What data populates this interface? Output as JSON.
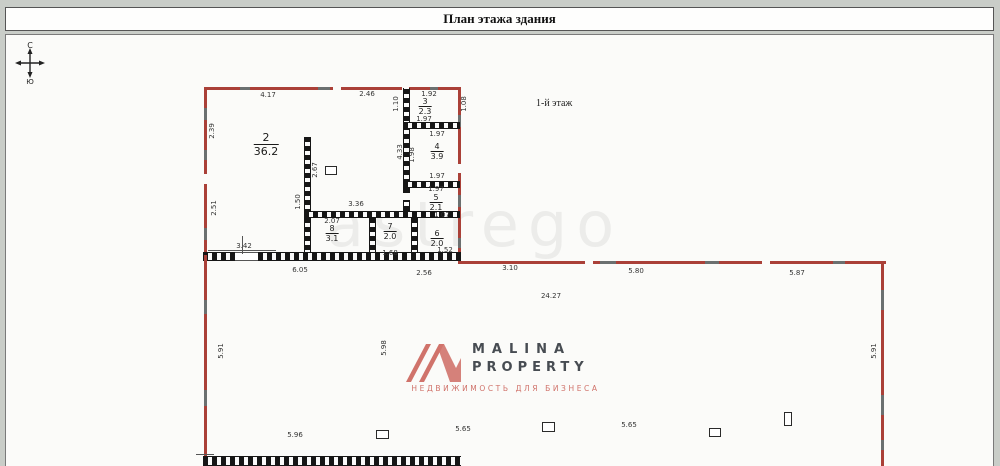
{
  "title": "План этажа здания",
  "floor_label": "1-й этаж",
  "watermark": "astrego",
  "compass": {
    "north": "С",
    "south": "Ю"
  },
  "logo": {
    "name": "MALINA",
    "type": "PROPERTY",
    "tagline": "НЕДВИЖИМОСТЬ ДЛЯ БИЗНЕСА",
    "accent_color": "#d0736b",
    "text_color": "#474c52"
  },
  "colors": {
    "outer_wall_red": "#aa4038",
    "interior_wall_black": "#161616",
    "page_background": "#c9cdc8"
  },
  "rooms": [
    {
      "number": "2",
      "area": "36.2",
      "x": 266,
      "y": 145,
      "large": true
    },
    {
      "number": "3",
      "area": "2.3",
      "x": 425,
      "y": 107
    },
    {
      "number": "4",
      "area": "3.9",
      "x": 437,
      "y": 152
    },
    {
      "number": "5",
      "area": "2.1",
      "x": 436,
      "y": 203
    },
    {
      "number": "6",
      "area": "2.0",
      "x": 437,
      "y": 239
    },
    {
      "number": "7",
      "area": "2.0",
      "x": 390,
      "y": 232
    },
    {
      "number": "8",
      "area": "3.1",
      "x": 332,
      "y": 234
    }
  ],
  "dimensions": [
    {
      "t": "4.17",
      "x": 268,
      "y": 95
    },
    {
      "t": "2.46",
      "x": 367,
      "y": 94
    },
    {
      "t": "1.92",
      "x": 429,
      "y": 94
    },
    {
      "t": "2.39",
      "x": 212,
      "y": 131,
      "r": true
    },
    {
      "t": "2.51",
      "x": 214,
      "y": 208,
      "r": true
    },
    {
      "t": "1.10",
      "x": 396,
      "y": 104,
      "r": true
    },
    {
      "t": "1.08",
      "x": 464,
      "y": 104,
      "r": true
    },
    {
      "t": "1.97",
      "x": 424,
      "y": 119
    },
    {
      "t": "1.97",
      "x": 437,
      "y": 134
    },
    {
      "t": "1.97",
      "x": 437,
      "y": 176
    },
    {
      "t": "1.97",
      "x": 436,
      "y": 189
    },
    {
      "t": "4.33",
      "x": 400,
      "y": 152,
      "r": true
    },
    {
      "t": "1.98",
      "x": 412,
      "y": 155,
      "r": true
    },
    {
      "t": "2.67",
      "x": 315,
      "y": 170,
      "r": true
    },
    {
      "t": "3.36",
      "x": 356,
      "y": 204
    },
    {
      "t": "2.07",
      "x": 332,
      "y": 221
    },
    {
      "t": "1.50",
      "x": 298,
      "y": 202,
      "r": true
    },
    {
      "t": "1.07",
      "x": 442,
      "y": 215
    },
    {
      "t": "1.52",
      "x": 445,
      "y": 250
    },
    {
      "t": "1.68",
      "x": 390,
      "y": 253
    },
    {
      "t": "3.42",
      "x": 244,
      "y": 246
    },
    {
      "t": "6.05",
      "x": 300,
      "y": 270
    },
    {
      "t": "2.56",
      "x": 424,
      "y": 273
    },
    {
      "t": "3.10",
      "x": 510,
      "y": 268
    },
    {
      "t": "5.80",
      "x": 636,
      "y": 271
    },
    {
      "t": "5.87",
      "x": 797,
      "y": 273
    },
    {
      "t": "24.27",
      "x": 551,
      "y": 296
    },
    {
      "t": "5.91",
      "x": 221,
      "y": 351,
      "r": true
    },
    {
      "t": "5.98",
      "x": 384,
      "y": 348,
      "r": true
    },
    {
      "t": "5.91",
      "x": 874,
      "y": 351,
      "r": true
    },
    {
      "t": "5.96",
      "x": 295,
      "y": 435
    },
    {
      "t": "5.65",
      "x": 463,
      "y": 429
    },
    {
      "t": "5.65",
      "x": 629,
      "y": 425
    }
  ]
}
